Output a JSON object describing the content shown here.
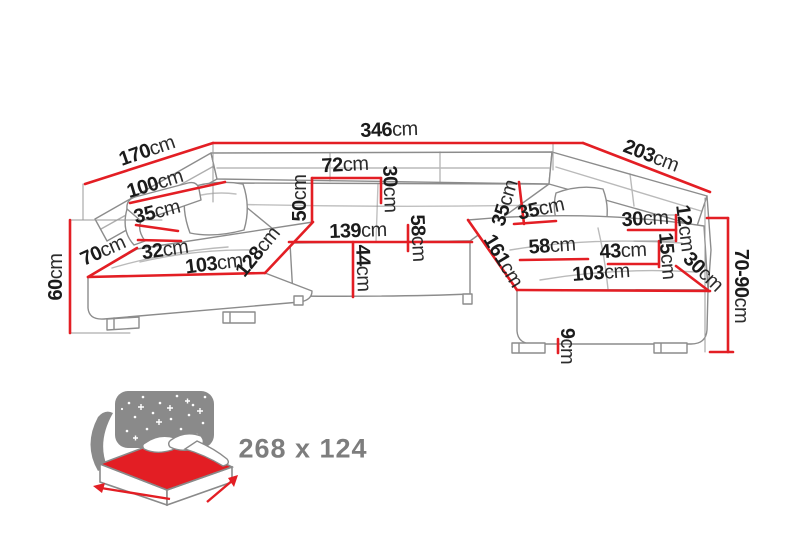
{
  "colors": {
    "background": "#ffffff",
    "dimension_line": "#e31e24",
    "sofa_outline": "#8c8c8c",
    "extension_line": "#9a9a9a",
    "label_text": "#1b1b1b",
    "icon_gray": "#8a8a8a",
    "size_text": "#7d7d7d"
  },
  "diagram": {
    "title": "corner-sofa-dimension-diagram",
    "unit": "cm",
    "labels": [
      {
        "id": "total-width-346",
        "value": "346",
        "unit": "cm",
        "x": 389,
        "y": 130,
        "rot": -2
      },
      {
        "id": "left-depth-170",
        "value": "170",
        "unit": "cm",
        "x": 147,
        "y": 151,
        "rot": -19
      },
      {
        "id": "right-depth-203",
        "value": "203",
        "unit": "cm",
        "x": 651,
        "y": 156,
        "rot": 21
      },
      {
        "id": "left-back-100",
        "value": "100",
        "unit": "cm",
        "x": 155,
        "y": 184,
        "rot": -17
      },
      {
        "id": "left-arm-35",
        "value": "35",
        "unit": "cm",
        "x": 157,
        "y": 212,
        "rot": -14
      },
      {
        "id": "left-end-70",
        "value": "70",
        "unit": "cm",
        "x": 103,
        "y": 251,
        "rot": -24
      },
      {
        "id": "left-arm-32",
        "value": "32",
        "unit": "cm",
        "x": 165,
        "y": 250,
        "rot": -8
      },
      {
        "id": "left-seat-103",
        "value": "103",
        "unit": "cm",
        "x": 214,
        "y": 264,
        "rot": -7
      },
      {
        "id": "left-seat-128",
        "value": "128",
        "unit": "cm",
        "x": 258,
        "y": 252,
        "rot": -51
      },
      {
        "id": "left-height-60",
        "value": "60",
        "unit": "cm",
        "x": 56,
        "y": 277,
        "rot": -90
      },
      {
        "id": "mid-back-50",
        "value": "50",
        "unit": "cm",
        "x": 300,
        "y": 198,
        "rot": -90
      },
      {
        "id": "mid-back-72",
        "value": "72",
        "unit": "cm",
        "x": 345,
        "y": 165,
        "rot": -3
      },
      {
        "id": "mid-back-30",
        "value": "30",
        "unit": "cm",
        "x": 390,
        "y": 189,
        "rot": 88
      },
      {
        "id": "mid-seat-139",
        "value": "139",
        "unit": "cm",
        "x": 358,
        "y": 231,
        "rot": -2
      },
      {
        "id": "mid-seat-58",
        "value": "58",
        "unit": "cm",
        "x": 418,
        "y": 238,
        "rot": 87
      },
      {
        "id": "mid-height-44",
        "value": "44",
        "unit": "cm",
        "x": 363,
        "y": 268,
        "rot": 88
      },
      {
        "id": "right-back-35-steep",
        "value": "35",
        "unit": "cm",
        "x": 505,
        "y": 203,
        "rot": -73
      },
      {
        "id": "right-back-35",
        "value": "35",
        "unit": "cm",
        "x": 541,
        "y": 209,
        "rot": -12
      },
      {
        "id": "right-head-30",
        "value": "30",
        "unit": "cm",
        "x": 645,
        "y": 219,
        "rot": -3
      },
      {
        "id": "right-head-12",
        "value": "12",
        "unit": "cm",
        "x": 685,
        "y": 228,
        "rot": 83
      },
      {
        "id": "right-head-15",
        "value": "15",
        "unit": "cm",
        "x": 667,
        "y": 256,
        "rot": 85
      },
      {
        "id": "right-seat-58",
        "value": "58",
        "unit": "cm",
        "x": 552,
        "y": 246,
        "rot": -4
      },
      {
        "id": "right-seat-43",
        "value": "43",
        "unit": "cm",
        "x": 623,
        "y": 251,
        "rot": -3
      },
      {
        "id": "right-seat-161",
        "value": "161",
        "unit": "cm",
        "x": 503,
        "y": 261,
        "rot": 59
      },
      {
        "id": "right-corner-30",
        "value": "30",
        "unit": "cm",
        "x": 703,
        "y": 272,
        "rot": 44
      },
      {
        "id": "right-seat-103",
        "value": "103",
        "unit": "cm",
        "x": 601,
        "y": 273,
        "rot": -4
      },
      {
        "id": "right-height-70-90",
        "value": "70-90",
        "unit": "cm",
        "x": 741,
        "y": 286,
        "rot": 90
      },
      {
        "id": "leg-height-9",
        "value": "9",
        "unit": "cm",
        "x": 567,
        "y": 346,
        "rot": 90
      }
    ],
    "red_lines": [
      {
        "id": "total-width-346",
        "x1": 213,
        "y1": 143,
        "x2": 583,
        "y2": 143
      },
      {
        "id": "left-depth-170",
        "x1": 85,
        "y1": 184,
        "x2": 213,
        "y2": 143
      },
      {
        "id": "right-depth-203",
        "x1": 583,
        "y1": 143,
        "x2": 710,
        "y2": 192
      },
      {
        "id": "left-back-100",
        "x1": 130,
        "y1": 203,
        "x2": 225,
        "y2": 182
      },
      {
        "id": "left-arm-35",
        "x1": 136,
        "y1": 225,
        "x2": 178,
        "y2": 231
      },
      {
        "id": "left-end-70",
        "x1": 88,
        "y1": 277,
        "x2": 137,
        "y2": 248
      },
      {
        "id": "left-arm-32",
        "x1": 138,
        "y1": 240,
        "x2": 181,
        "y2": 241
      },
      {
        "id": "left-seat-103",
        "x1": 88,
        "y1": 277,
        "x2": 265,
        "y2": 273
      },
      {
        "id": "left-seat-128",
        "x1": 265,
        "y1": 273,
        "x2": 313,
        "y2": 222
      },
      {
        "id": "mid-seat-139",
        "x1": 289,
        "y1": 242,
        "x2": 472,
        "y2": 242
      },
      {
        "id": "mid-back-50",
        "x1": 312,
        "y1": 178,
        "x2": 312,
        "y2": 222
      },
      {
        "id": "mid-back-72",
        "x1": 312,
        "y1": 178,
        "x2": 381,
        "y2": 178
      },
      {
        "id": "mid-back-30",
        "x1": 381,
        "y1": 178,
        "x2": 381,
        "y2": 203
      },
      {
        "id": "mid-seat-58",
        "x1": 408,
        "y1": 225,
        "x2": 408,
        "y2": 251
      },
      {
        "id": "mid-height-44",
        "x1": 353,
        "y1": 242,
        "x2": 353,
        "y2": 297
      },
      {
        "id": "right-seat-161",
        "x1": 468,
        "y1": 220,
        "x2": 517,
        "y2": 290
      },
      {
        "id": "right-back-35-steep",
        "x1": 519,
        "y1": 182,
        "x2": 524,
        "y2": 224
      },
      {
        "id": "right-back-35",
        "x1": 514,
        "y1": 224,
        "x2": 556,
        "y2": 221
      },
      {
        "id": "right-seat-58",
        "x1": 520,
        "y1": 260,
        "x2": 588,
        "y2": 259
      },
      {
        "id": "right-seat-43",
        "x1": 608,
        "y1": 264,
        "x2": 658,
        "y2": 264
      },
      {
        "id": "right-seat-103",
        "x1": 517,
        "y1": 290,
        "x2": 710,
        "y2": 291
      },
      {
        "id": "right-head-30",
        "x1": 628,
        "y1": 230,
        "x2": 676,
        "y2": 230
      },
      {
        "id": "right-head-12",
        "x1": 676,
        "y1": 215,
        "x2": 676,
        "y2": 241
      },
      {
        "id": "right-head-15",
        "x1": 659,
        "y1": 241,
        "x2": 659,
        "y2": 267
      },
      {
        "id": "right-corner-30",
        "x1": 676,
        "y1": 266,
        "x2": 709,
        "y2": 291
      },
      {
        "id": "right-height-70-90",
        "x1": 728,
        "y1": 218,
        "x2": 728,
        "y2": 352
      },
      {
        "id": "right-height-tick-top",
        "x1": 707,
        "y1": 218,
        "x2": 728,
        "y2": 218
      },
      {
        "id": "right-height-tick-bottom",
        "x1": 710,
        "y1": 352,
        "x2": 733,
        "y2": 352
      },
      {
        "id": "left-height-60",
        "x1": 70,
        "y1": 220,
        "x2": 70,
        "y2": 333
      },
      {
        "id": "leg-height-9",
        "x1": 558,
        "y1": 339,
        "x2": 558,
        "y2": 353
      }
    ],
    "gray_lines": [
      {
        "id": "ext-corner-left",
        "x1": 213,
        "y1": 143,
        "x2": 213,
        "y2": 202
      },
      {
        "id": "ext-corner-right",
        "x1": 553,
        "y1": 143,
        "x2": 553,
        "y2": 170
      },
      {
        "id": "ext-left-top",
        "x1": 83,
        "y1": 184,
        "x2": 83,
        "y2": 220
      },
      {
        "id": "ext-60-top",
        "x1": 70,
        "y1": 220,
        "x2": 162,
        "y2": 220
      },
      {
        "id": "ext-60-bottom",
        "x1": 70,
        "y1": 333,
        "x2": 130,
        "y2": 333
      },
      {
        "id": "ext-right-side",
        "x1": 705,
        "y1": 198,
        "x2": 705,
        "y2": 352
      },
      {
        "id": "ext-12-top",
        "x1": 648,
        "y1": 215,
        "x2": 676,
        "y2": 215
      },
      {
        "id": "ext-12-15",
        "x1": 634,
        "y1": 241,
        "x2": 676,
        "y2": 241
      }
    ]
  },
  "sleep_function": {
    "icon": "fold-out-bed-icon",
    "size_label": "268 x 124"
  }
}
